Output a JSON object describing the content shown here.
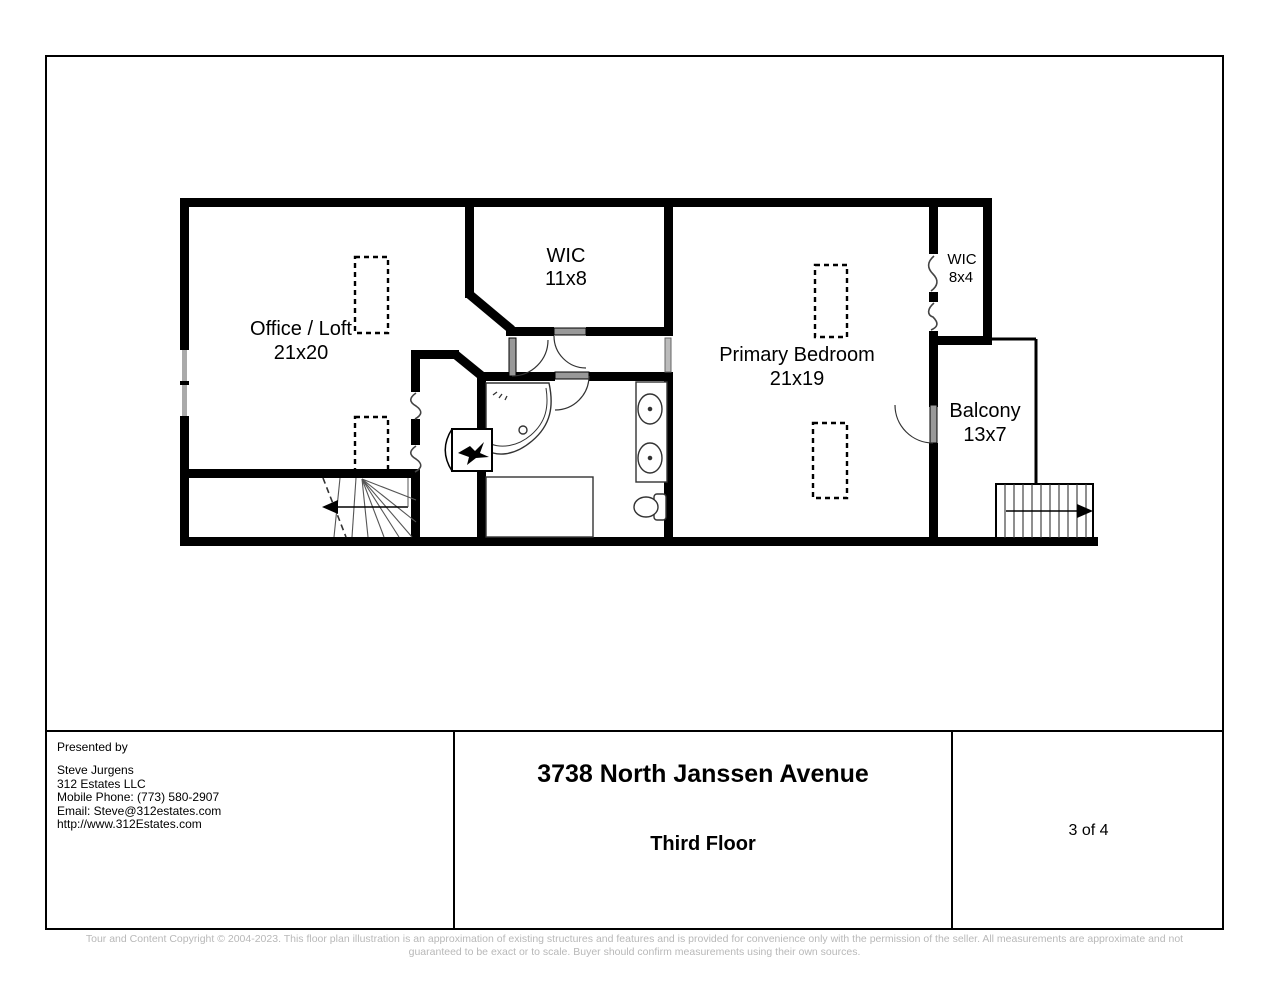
{
  "page": {
    "title": "3738 North Janssen Avenue",
    "subtitle": "Third Floor",
    "page_number": "3 of 4",
    "presented_by_label": "Presented by",
    "contact": {
      "name": "Steve Jurgens",
      "company": "312 Estates LLC",
      "phone": "Mobile Phone: (773) 580-2907",
      "email": "Email: Steve@312estates.com",
      "website": "http://www.312Estates.com"
    },
    "disclaimer_line1": "Tour and Content Copyright © 2004-2023. This floor plan illustration is an approximation of existing structures and features and is provided for convenience only with the permission of the seller. All measurements are approximate and not",
    "disclaimer_line2": "guaranteed to be exact or to scale. Buyer should confirm measurements using their own sources."
  },
  "floor_plan": {
    "rooms": [
      {
        "name": "Office / Loft",
        "dimensions": "21x20"
      },
      {
        "name": "WIC",
        "dimensions": "11x8"
      },
      {
        "name": "Primary Bedroom",
        "dimensions": "21x19"
      },
      {
        "name": "WIC",
        "dimensions": "8x4"
      },
      {
        "name": "Balcony",
        "dimensions": "13x7"
      }
    ],
    "fixtures": [
      "corner-tub",
      "double-sink-vanity",
      "toilet",
      "shower",
      "winder-stairs-down",
      "straight-stairs-down",
      "mechanical-unit"
    ],
    "wall_color": "#000000",
    "door_color": "#999999"
  }
}
